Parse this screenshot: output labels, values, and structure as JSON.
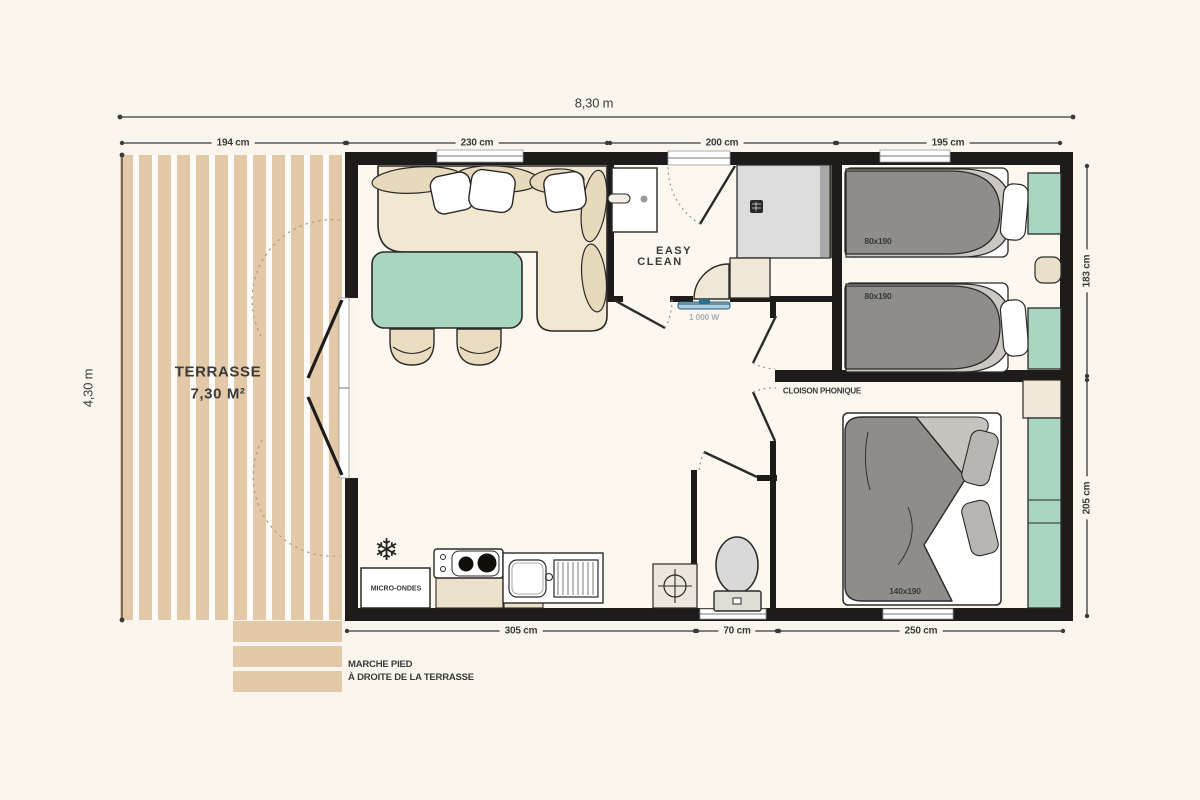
{
  "plan": {
    "overall": {
      "width_label": "8,30 m",
      "depth_label": "4,30 m"
    },
    "dims_top": [
      "194 cm",
      "230 cm",
      "200 cm",
      "195 cm"
    ],
    "dims_right": [
      "183 cm",
      "205 cm"
    ],
    "dims_bottom": [
      "305 cm",
      "70 cm",
      "250 cm"
    ],
    "terrace": {
      "name": "TERRASSE",
      "area": "7,30 M²"
    },
    "bathroom": {
      "logo_top": "EASY",
      "logo_bottom": "CLEAN",
      "heater_power": "1 000 W"
    },
    "kitchen": {
      "microwave": "MICRO-ONDES"
    },
    "bedroom_twin": {
      "bed1_size": "80x190",
      "bed2_size": "80x190"
    },
    "bedroom_master": {
      "bed_size": "140x190",
      "partition_label": "CLOISON PHONIQUE"
    },
    "footnote": {
      "line1": "MARCHE PIED",
      "line2": "À DROITE DE LA TERRASSE"
    },
    "icons": {
      "snowflake": "❄"
    },
    "colors": {
      "wall": "#1d1c1a",
      "wood": "#e3c9a7",
      "green": "#a9d6c1",
      "sofa": "#f2e8d2",
      "duvet": "#8e8d8b",
      "radiator": "#a9cfe2"
    }
  }
}
